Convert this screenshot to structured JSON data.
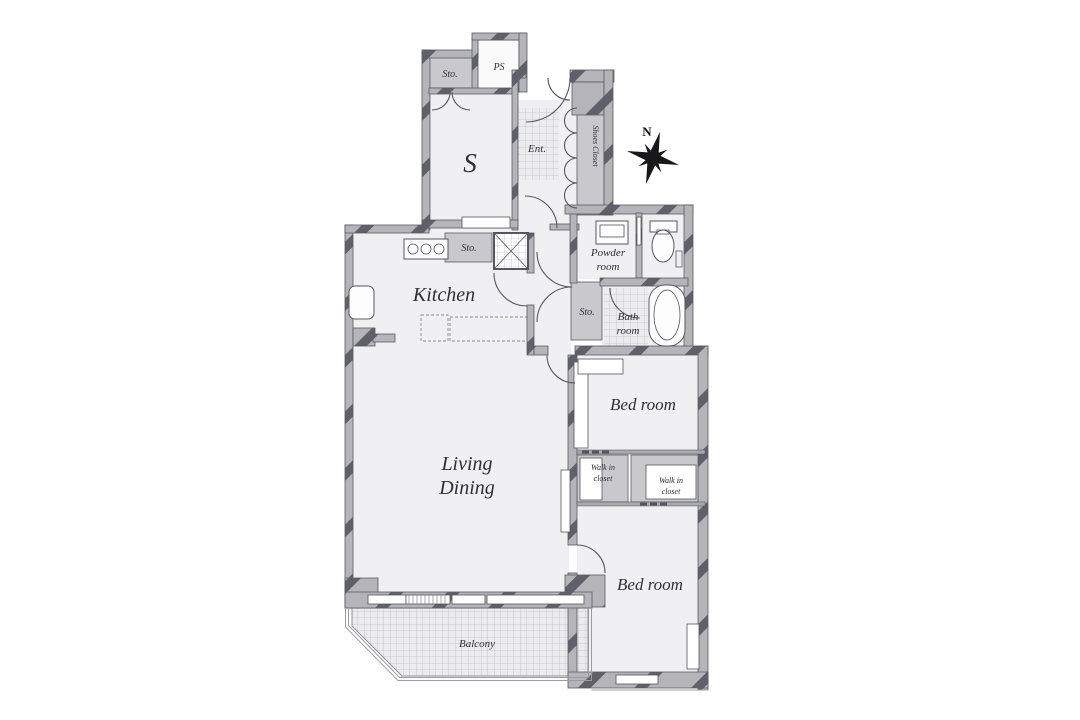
{
  "colors": {
    "wall": "#b4b4b9",
    "wallStripe": "#60606b",
    "floor": "#f0f0f2",
    "floorBright": "#fafafb",
    "shaded": "#c8c8cd",
    "tileFill": "#ececef",
    "text": "#2f2f37",
    "compass": "#17171c"
  },
  "labels": {
    "storage_top": "Sto.",
    "pipe_space": "PS",
    "service_room": "S",
    "entrance": "Ent.",
    "shoes_closet": "Shoes Closet",
    "north": "N",
    "kitchen": "Kitchen",
    "storage_kitchen": "Sto.",
    "powder_line1": "Powder",
    "powder_line2": "room",
    "storage_hall": "Sto.",
    "bath_line1": "Bath",
    "bath_line2": "room",
    "bedroom_upper": "Bed room",
    "wic_left_line1": "Walk in",
    "wic_left_line2": "closet",
    "wic_right_line1": "Walk in",
    "wic_right_line2": "closet",
    "living_line1": "Living",
    "living_line2": "Dining",
    "bedroom_lower": "Bed room",
    "balcony": "Balcony"
  }
}
